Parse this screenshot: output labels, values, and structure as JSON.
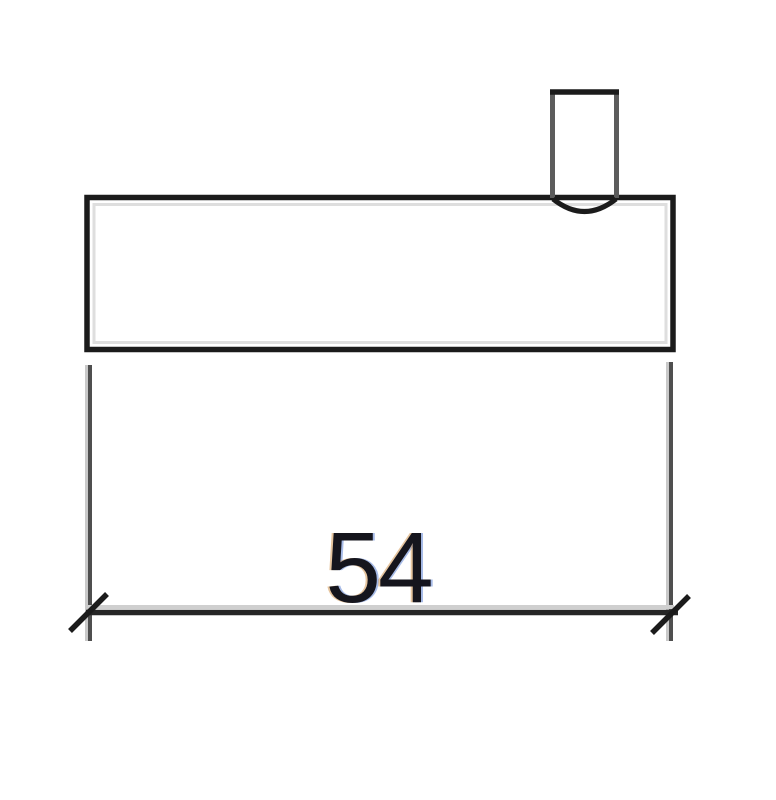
{
  "drawing": {
    "dimension_label": "54",
    "colors": {
      "outline": "#1b1b1b",
      "tab_vertical": "#5c5c5c",
      "extension_line_dark": "#4f4f4f",
      "extension_line_light": "#c9c9c9",
      "dimension_line": "#262626",
      "dimension_line_halo": "#cfcfcf",
      "inner_halo": "#dedede",
      "label_text": "#15151d",
      "background": "#ffffff"
    }
  }
}
